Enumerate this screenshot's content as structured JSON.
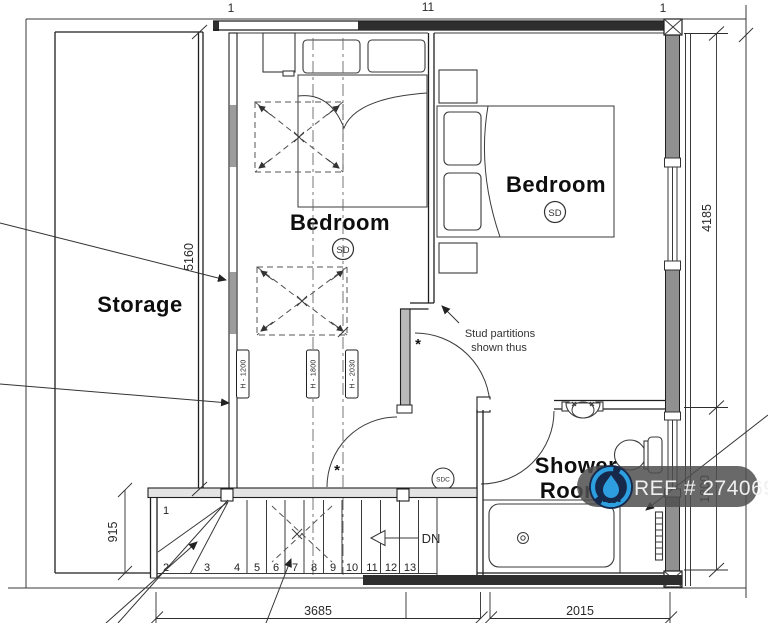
{
  "drawing": {
    "rooms": {
      "storage": "Storage",
      "bedroom_left": "Bedroom",
      "bedroom_right": "Bedroom",
      "shower_line1": "Shower",
      "shower_line2": "Room"
    },
    "detectors": {
      "sd_left": "SD",
      "sd_right": "SD",
      "sdc": "SDC"
    },
    "annotations": {
      "stud_note_line1": "Stud partitions",
      "stud_note_line2": "shown thus",
      "down": "DN",
      "asterisk": "*"
    },
    "dimensions": {
      "storage_wall": "5160",
      "bedroom_right_depth": "4185",
      "shower_depth": "1800",
      "landing_width": "915",
      "bottom_left": "3685",
      "bottom_right": "2015"
    },
    "head_heights": {
      "h1200": "H - 1200",
      "h1800": "H - 1800",
      "h2030": "H - 2030"
    },
    "stairs": {
      "treads": [
        "1",
        "2",
        "3",
        "4",
        "5",
        "6",
        "7",
        "8",
        "9",
        "10",
        "11",
        "12",
        "13"
      ]
    },
    "top_edge_labels": [
      "1",
      "11",
      "1"
    ],
    "watermark": {
      "text": "REF # 2740693",
      "bg": "#4f4f4f",
      "logo_blue": "#2d9ee0",
      "logo_navy": "#17294a"
    },
    "colors": {
      "wall": "#1f1f1f",
      "solid_wall_fill": "#2e2e2e",
      "masonry_gray": "#909090",
      "stud_hatch": "#9c9c9c"
    }
  }
}
